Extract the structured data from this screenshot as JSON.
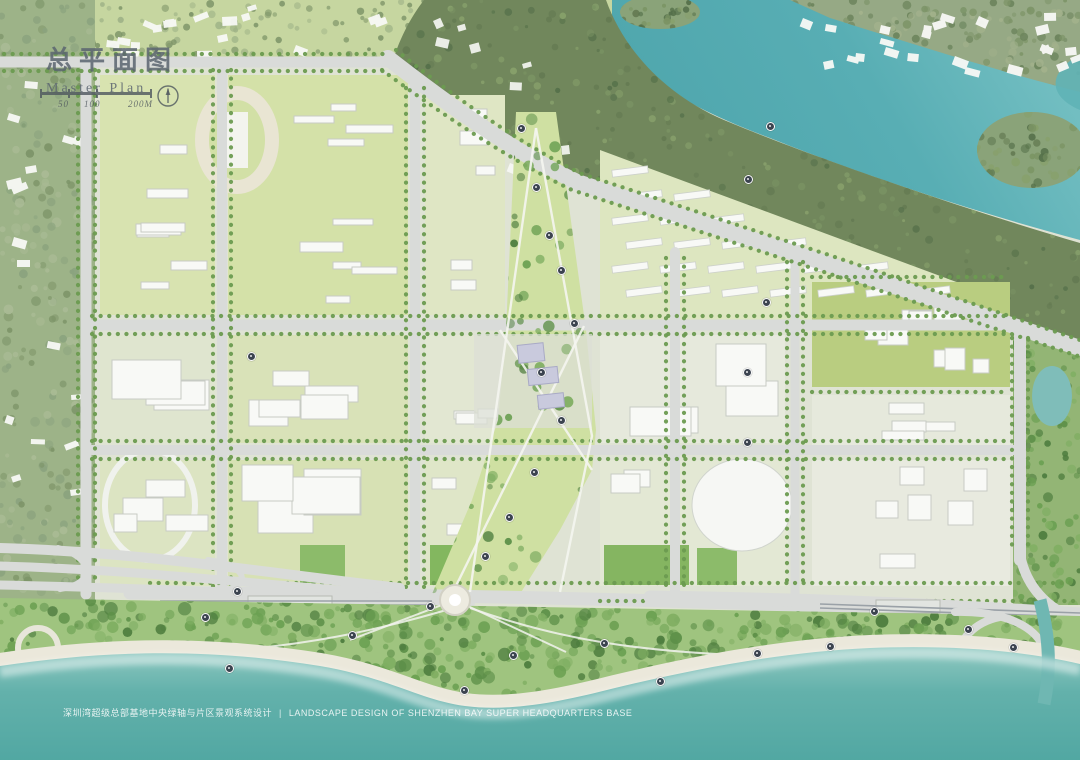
{
  "header": {
    "title_zh": "总平面图",
    "title_en": "Master Plan"
  },
  "scale_bar": {
    "tick_labels": [
      "50",
      "100",
      "200M"
    ]
  },
  "footer": {
    "caption_zh": "深圳湾超级总部基地中央绿轴与片区景观系统设计",
    "separator": "|",
    "caption_en": "LANDSCAPE DESIGN OF SHENZHEN BAY SUPER HEADQUARTERS BASE"
  },
  "palette": {
    "sea_deep": "#4fa6a1",
    "sea_shallow": "#8cc7bf",
    "lake": "#58aeb4",
    "lake_light": "#7cc4c6",
    "land": "#dfe3d4",
    "road": "#d9dbd9",
    "forest": "#71875c",
    "park": "#9fc47f",
    "lawn_light": "#d8e3b0",
    "lawn_lime": "#b9cd80",
    "sand": "#ebe8db",
    "tree": "#6b9b50",
    "hill": "#9db388",
    "bldg": "#f8f9f6",
    "bldg_edge": "#c7cbc4",
    "marker": "#3c4450",
    "title": "#5b6570"
  },
  "map": {
    "markers": [
      {
        "x": 521,
        "y": 128
      },
      {
        "x": 536,
        "y": 187
      },
      {
        "x": 549,
        "y": 235
      },
      {
        "x": 561,
        "y": 270
      },
      {
        "x": 574,
        "y": 323
      },
      {
        "x": 541,
        "y": 372
      },
      {
        "x": 561,
        "y": 420
      },
      {
        "x": 534,
        "y": 472
      },
      {
        "x": 509,
        "y": 517
      },
      {
        "x": 485,
        "y": 556
      },
      {
        "x": 205,
        "y": 617
      },
      {
        "x": 237,
        "y": 591
      },
      {
        "x": 229,
        "y": 668
      },
      {
        "x": 352,
        "y": 635
      },
      {
        "x": 430,
        "y": 606
      },
      {
        "x": 464,
        "y": 690
      },
      {
        "x": 513,
        "y": 655
      },
      {
        "x": 604,
        "y": 643
      },
      {
        "x": 660,
        "y": 681
      },
      {
        "x": 757,
        "y": 653
      },
      {
        "x": 830,
        "y": 646
      },
      {
        "x": 874,
        "y": 611
      },
      {
        "x": 968,
        "y": 629
      },
      {
        "x": 1013,
        "y": 647
      },
      {
        "x": 251,
        "y": 356
      },
      {
        "x": 766,
        "y": 302
      },
      {
        "x": 747,
        "y": 372
      },
      {
        "x": 747,
        "y": 442
      },
      {
        "x": 770,
        "y": 126
      },
      {
        "x": 748,
        "y": 179
      }
    ]
  }
}
